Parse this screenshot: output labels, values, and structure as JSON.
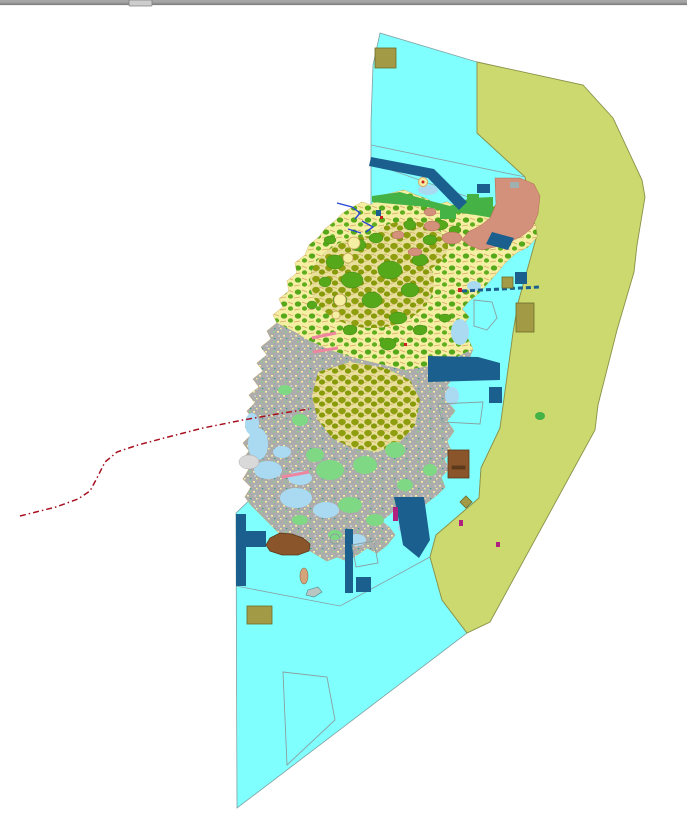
{
  "window": {
    "top_bar": {
      "bar_color": "#8f8f8f",
      "bar_highlight": "#a6a6a6",
      "bar_shadow": "#6e6e6e",
      "tab_color": "#cdcdcd"
    }
  },
  "map": {
    "background": "#ffffff",
    "palette": {
      "water": "#80ffff",
      "water_edge": "#7fa0a0",
      "outer_zone": "#cbd96e",
      "outer_zone_edge": "#8a9148",
      "island_base": "#f5efa3",
      "island_edge": "#c9a05a",
      "forest_green": "#55a81a",
      "bright_green": "#44b244",
      "light_green": "#7fd884",
      "dense_olive": "#8f9e0e",
      "salmon": "#d3907a",
      "urban_gray": "#acacac",
      "bay_blue": "#a9daf2",
      "navy": "#1a5f8e",
      "brown": "#8a552b",
      "brown_edge": "#5a3a1a",
      "olive_square": "#a39a45",
      "olive_square_edge": "#6b6b2a",
      "red_line": "#a81020",
      "pink_line": "#ef86a0",
      "river_blue": "#2a46d4",
      "outline_gray": "#8aa0a0",
      "magenta": "#b02080",
      "red_dot": "#cc2020",
      "islet_tan": "#d4a57a",
      "islet_gray": "#b9c6c2",
      "shoal_gray": "#d9d9d9"
    }
  }
}
